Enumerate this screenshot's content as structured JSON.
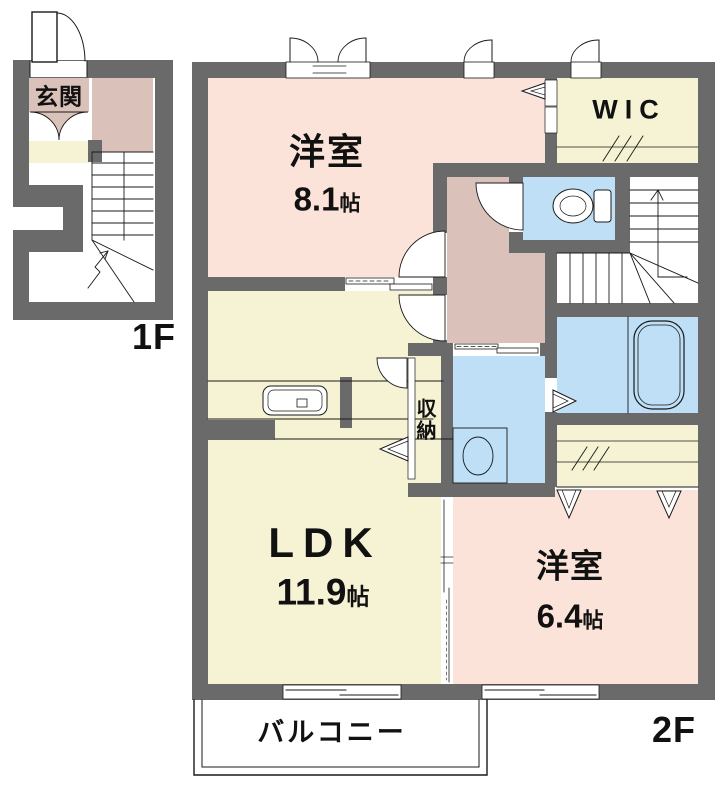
{
  "floors": {
    "first": {
      "label": "1F"
    },
    "second": {
      "label": "2F"
    }
  },
  "rooms": {
    "entrance": {
      "name": "玄関"
    },
    "bedroom81": {
      "name": "洋室",
      "size": "8.1",
      "unit": "帖"
    },
    "wic": {
      "name": "WIC"
    },
    "ldk": {
      "name": "LDK",
      "size": "11.9",
      "unit": "帖"
    },
    "storage": {
      "name": "収納"
    },
    "bedroom64": {
      "name": "洋室",
      "size": "6.4",
      "unit": "帖"
    },
    "balcony": {
      "name": "バルコニー"
    }
  },
  "colors": {
    "wall": "#6a6a6a",
    "western_room_pink": "#fbe3d9",
    "hall_mauve": "#dac2ba",
    "closet_cream": "#f5f3d3",
    "wet_area_blue": "#bedff5",
    "line": "#1a1a1a"
  }
}
